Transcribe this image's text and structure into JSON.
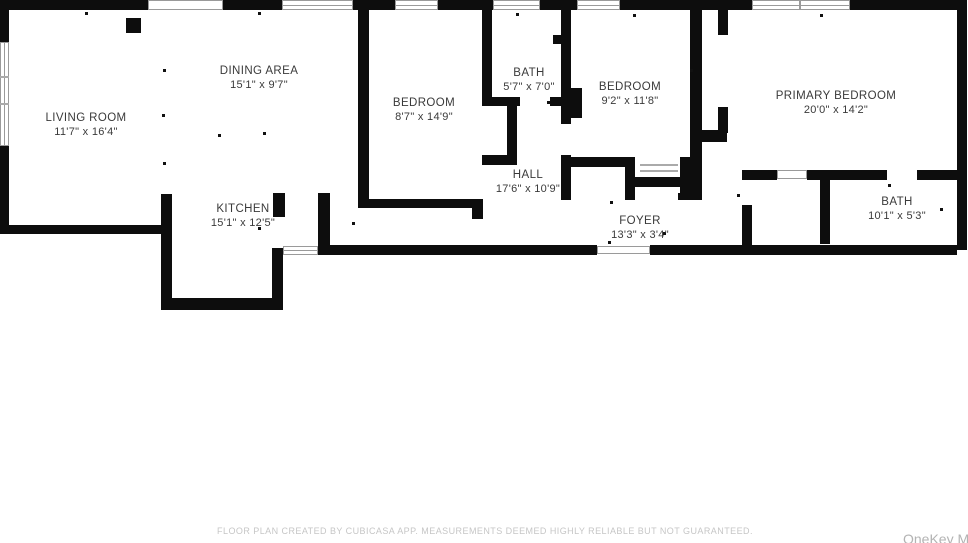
{
  "rooms": [
    {
      "name": "LIVING ROOM",
      "dims": "11'7\" x 16'4\""
    },
    {
      "name": "DINING AREA",
      "dims": "15'1\" x 9'7\""
    },
    {
      "name": "KITCHEN",
      "dims": "15'1\" x 12'5\""
    },
    {
      "name": "BEDROOM",
      "dims": "8'7\" x 14'9\""
    },
    {
      "name": "BATH",
      "dims": "5'7\" x 7'0\""
    },
    {
      "name": "HALL",
      "dims": "17'6\" x 10'9\""
    },
    {
      "name": "BEDROOM",
      "dims": "9'2\" x 11'8\""
    },
    {
      "name": "FOYER",
      "dims": "13'3\" x 3'4\""
    },
    {
      "name": "PRIMARY BEDROOM",
      "dims": "20'0\" x 14'2\""
    },
    {
      "name": "BATH",
      "dims": "10'1\" x 5'3\""
    }
  ],
  "footer": {
    "disclaimer": "FLOOR PLAN CREATED BY CUBICASA APP. MEASUREMENTS DEEMED HIGHLY RELIABLE BUT NOT GUARANTEED."
  },
  "watermark": {
    "text": "OneKey M"
  },
  "colors": {
    "wall": "#0d0d0d",
    "label": "#3a3a3a",
    "footer_text": "#c6c6c6",
    "background": "#ffffff"
  }
}
